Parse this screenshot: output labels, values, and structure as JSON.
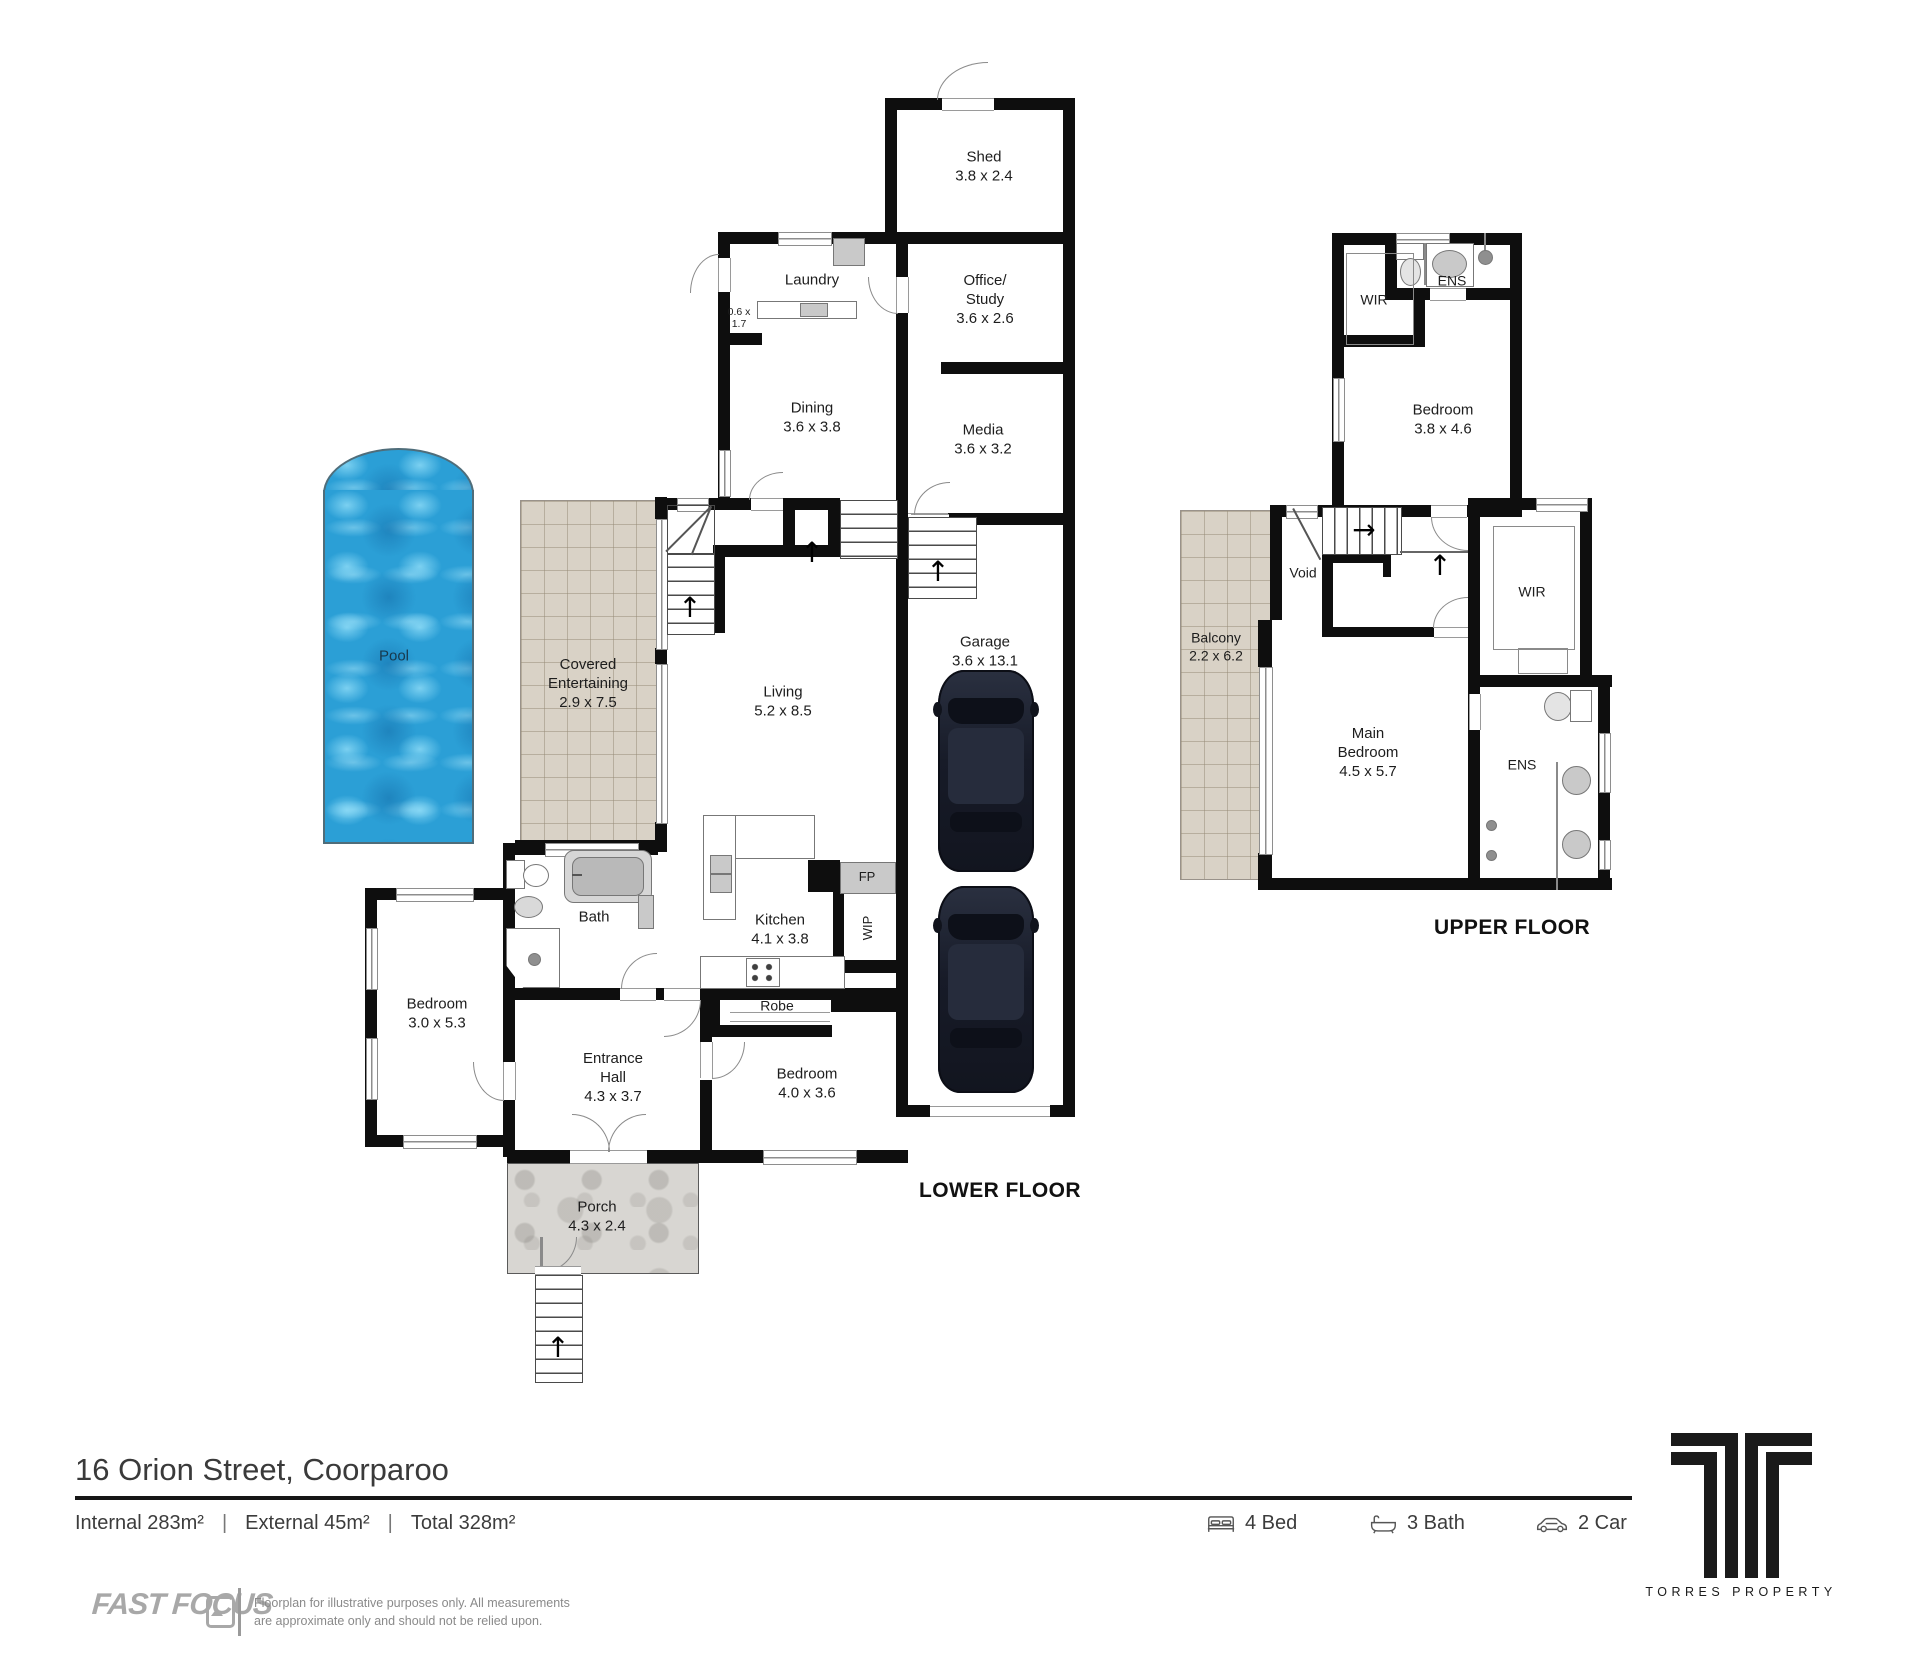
{
  "palette": {
    "wall_black": "#0e0e0e",
    "pool_blue": "#2b9fd6",
    "tile_beige": "#d9d2c6",
    "porch_gray": "#d8d6d2",
    "car_navy": "#171b28"
  },
  "lower": {
    "floor_label": "LOWER FLOOR",
    "shed": {
      "name": "Shed",
      "dims": "3.8 x 2.4"
    },
    "laundry": {
      "name": "Laundry"
    },
    "nook": {
      "dims": "0.6 x\n1.7"
    },
    "office": {
      "name": "Office/\nStudy",
      "dims": "3.6 x 2.6"
    },
    "dining": {
      "name": "Dining",
      "dims": "3.6 x 3.8"
    },
    "media": {
      "name": "Media",
      "dims": "3.6 x 3.2"
    },
    "garage": {
      "name": "Garage",
      "dims": "3.6 x 13.1"
    },
    "living": {
      "name": "Living",
      "dims": "5.2 x 8.5"
    },
    "covered": {
      "name": "Covered\nEntertaining",
      "dims": "2.9 x 7.5"
    },
    "pool": {
      "name": "Pool"
    },
    "bath": {
      "name": "Bath"
    },
    "kitchen": {
      "name": "Kitchen",
      "dims": "4.1 x 3.8"
    },
    "fp": {
      "name": "FP"
    },
    "wip": {
      "name": "WIP"
    },
    "robe": {
      "name": "Robe"
    },
    "bedroom1": {
      "name": "Bedroom",
      "dims": "3.0 x 5.3"
    },
    "hall": {
      "name": "Entrance\nHall",
      "dims": "4.3 x 3.7"
    },
    "bedroom2": {
      "name": "Bedroom",
      "dims": "4.0 x 3.6"
    },
    "porch": {
      "name": "Porch",
      "dims": "4.3 x 2.4"
    }
  },
  "upper": {
    "floor_label": "UPPER FLOOR",
    "wir1": {
      "name": "WIR"
    },
    "ens1": {
      "name": "ENS"
    },
    "bedroom3": {
      "name": "Bedroom",
      "dims": "3.8 x 4.6"
    },
    "void": {
      "name": "Void"
    },
    "balcony": {
      "name": "Balcony",
      "dims": "2.2 x 6.2"
    },
    "wir2": {
      "name": "WIR"
    },
    "main_bedroom": {
      "name": "Main\nBedroom",
      "dims": "4.5 x 5.7"
    },
    "ens2": {
      "name": "ENS"
    }
  },
  "footer": {
    "address": "16 Orion Street, Coorparoo",
    "internal": "Internal 283m²",
    "external": "External 45m²",
    "total": "Total 328m²",
    "separator": "|",
    "beds": "4 Bed",
    "baths": "3 Bath",
    "cars": "2 Car",
    "brand": "FAST FOCUS",
    "disclaimer1": "Floorplan for illustrative purposes only. All measurements",
    "disclaimer2": "are approximate only and should not be relied upon.",
    "agency": "TORRES PROPERTY"
  }
}
